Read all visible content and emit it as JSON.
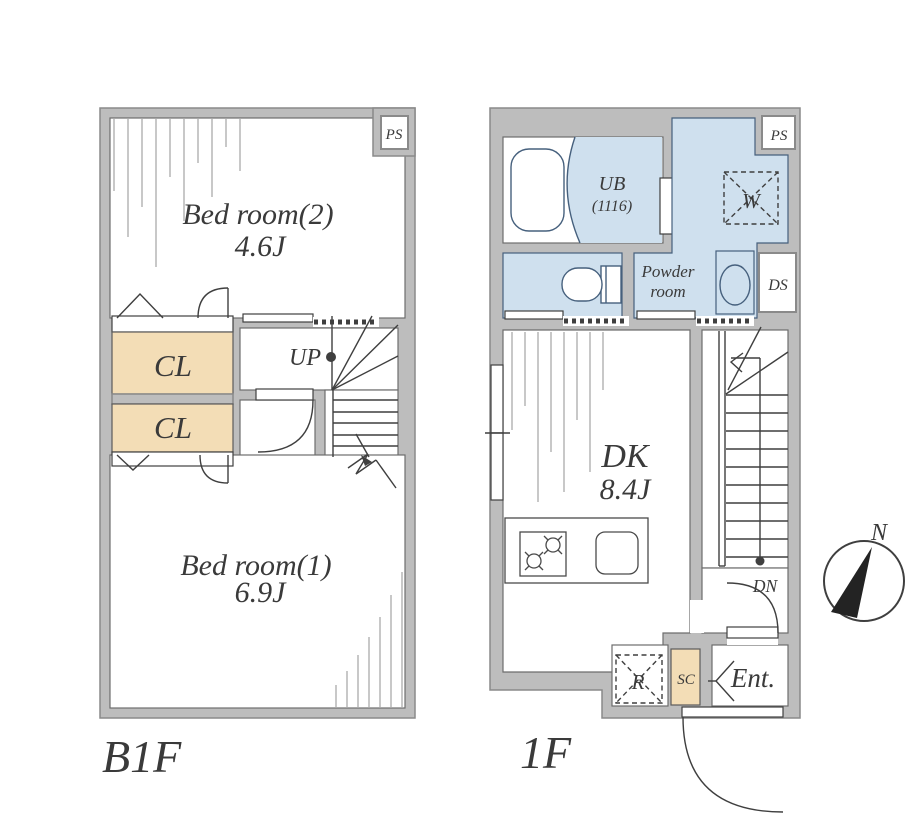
{
  "b1f": {
    "title": "B1F",
    "bedroom2_name": "Bed room(2)",
    "bedroom2_size": "4.6J",
    "bedroom1_name": "Bed room(1)",
    "bedroom1_size": "6.9J",
    "closet1": "CL",
    "closet2": "CL",
    "ps": "PS",
    "up": "UP"
  },
  "f1": {
    "title": "1F",
    "ub": "UB",
    "ub_size": "(1116)",
    "powder_line1": "Powder",
    "powder_line2": "room",
    "washer": "W",
    "ps": "PS",
    "ds": "DS",
    "dk_name": "DK",
    "dk_size": "8.4J",
    "dn": "DN",
    "fridge": "R",
    "shoe_closet": "SC",
    "entrance": "Ent."
  },
  "compass": {
    "north": "N"
  },
  "colors": {
    "wall": "#bdbdbd",
    "wall_edge": "#8a8a8a",
    "wet": "#cfe0ee",
    "wet_edge": "#46607d",
    "closet": "#f3ddb6",
    "line": "#3f3f3f",
    "text": "#3a3a3a"
  }
}
